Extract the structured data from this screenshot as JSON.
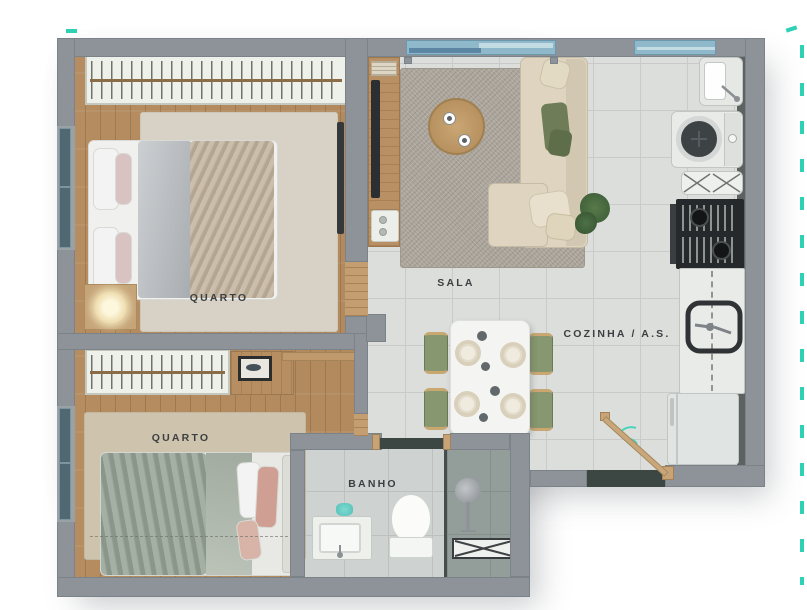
{
  "meta": {
    "type": "apartment-floor-plan",
    "language": "pt-BR",
    "view": "top-down"
  },
  "rooms": [
    {
      "id": "quarto-1",
      "label": "QUARTO"
    },
    {
      "id": "sala",
      "label": "SALA"
    },
    {
      "id": "cozinha-as",
      "label": "COZINHA / A.S."
    },
    {
      "id": "quarto-2",
      "label": "QUARTO"
    },
    {
      "id": "banho",
      "label": "BANHO"
    }
  ],
  "furniture": {
    "quarto_1": [
      "wardrobe",
      "double-bed",
      "nightstand-with-lamp",
      "wall-tv",
      "rug"
    ],
    "sala": [
      "tv-rack-with-books",
      "l-shaped-sofa",
      "round-coffee-table",
      "plant",
      "rug",
      "balcony-glass-door"
    ],
    "cozinha_as": [
      "laundry-tank",
      "washing-machine",
      "folding-rack",
      "cooktop",
      "counter-with-sink",
      "fridge",
      "dining-table-4-plates",
      "4-green-chairs",
      "entry-door"
    ],
    "quarto_2": [
      "wardrobe",
      "desk-with-picture",
      "double-bed",
      "rug"
    ],
    "banho": [
      "vanity-sink",
      "toilet",
      "shower-with-glass-partition",
      "floor-grate"
    ]
  },
  "colors": {
    "wall": "#8d9399",
    "wood_floor": "#b48c60",
    "tile_floor": "#dcdedc",
    "bath_tile": "#ced2d0",
    "shower_tile": "#939d99",
    "threshold_dark": "#3c4642",
    "bedroom_rug": "#d7d2c5",
    "sala_rug": "#aba59b",
    "sofa_beige": "#ded4c0",
    "chair_green": "#87976f",
    "cushion_green": "#6e7c57",
    "glass_blue": "#8fb9ca",
    "window_teal": "#4f6871",
    "door_wood": "#c8a87b",
    "accent_teal": "#2fd1b4",
    "label_text": "#3c3f42"
  }
}
